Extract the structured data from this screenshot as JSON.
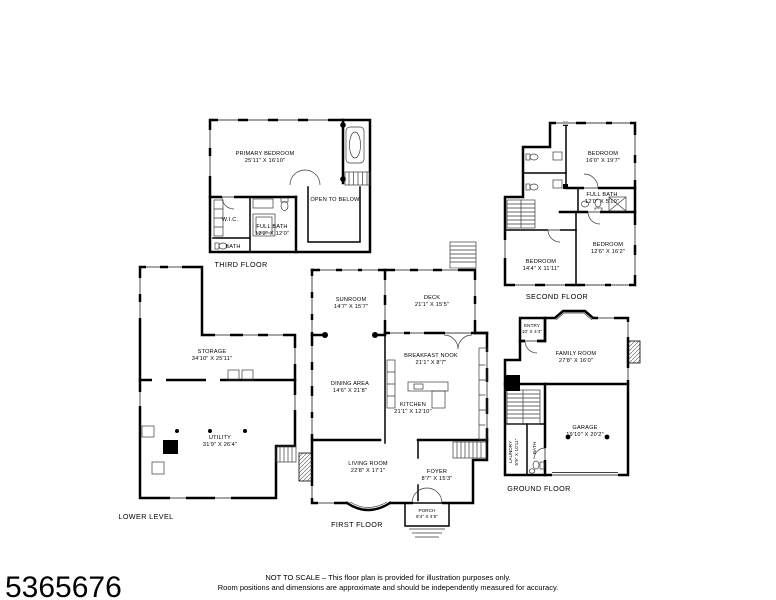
{
  "photo_id": "5365676",
  "colors": {
    "line": "#000000",
    "background": "#ffffff"
  },
  "footer": {
    "line1": "NOT TO SCALE – This floor plan is provided for illustration purposes only.",
    "line2": "Room positions and dimensions are approximate and should be independently measured for accuracy."
  },
  "floors": {
    "third": {
      "label": "THIRD FLOOR",
      "rooms": [
        {
          "name": "PRIMARY BEDROOM",
          "dims": "25'11\" X 16'10\""
        },
        {
          "name": "OPEN TO BELOW",
          "dims": ""
        },
        {
          "name": "W.I.C.",
          "dims": ""
        },
        {
          "name": "FULL BATH",
          "dims": "12'2\" X 12'0\""
        },
        {
          "name": "BATH",
          "dims": ""
        }
      ]
    },
    "second": {
      "label": "SECOND FLOOR",
      "rooms": [
        {
          "name": "BEDROOM",
          "dims": "16'0\" X 19'7\""
        },
        {
          "name": "FULL BATH",
          "dims": "12'0\" X 5'10\""
        },
        {
          "name": "BEDROOM",
          "dims": "12'6\" X 16'2\""
        },
        {
          "name": "BEDROOM",
          "dims": "14'4\" X 11'11\""
        }
      ]
    },
    "first": {
      "label": "FIRST FLOOR",
      "rooms": [
        {
          "name": "SUNROOM",
          "dims": "14'7\" X 15'7\""
        },
        {
          "name": "DECK",
          "dims": "21'1\" X 15'5\""
        },
        {
          "name": "BREAKFAST NOOK",
          "dims": "21'1\" X 8'7\""
        },
        {
          "name": "DINING AREA",
          "dims": "14'6\" X 21'8\""
        },
        {
          "name": "KITCHEN",
          "dims": "21'1\" X 12'10\""
        },
        {
          "name": "LIVING ROOM",
          "dims": "22'8\" X 17'1\""
        },
        {
          "name": "FOYER",
          "dims": "8'7\" X 15'3\""
        },
        {
          "name": "PORCH",
          "dims": "9'4\" X 4'5\""
        }
      ]
    },
    "lower": {
      "label": "LOWER LEVEL",
      "rooms": [
        {
          "name": "STORAGE",
          "dims": "34'10\" X 25'11\""
        },
        {
          "name": "UTILITY",
          "dims": "31'9\" X 26'4\""
        }
      ]
    },
    "ground": {
      "label": "GROUND FLOOR",
      "rooms": [
        {
          "name": "ENTRY",
          "dims": "10' X 4'4\""
        },
        {
          "name": "FAMILY ROOM",
          "dims": "27'8\" X 16'0\""
        },
        {
          "name": "GARAGE",
          "dims": "19'10\" X 20'2\""
        },
        {
          "name": "LAUNDRY",
          "dims": "5'9\" X 10'11\""
        },
        {
          "name": "BATH",
          "dims": ""
        }
      ]
    }
  }
}
